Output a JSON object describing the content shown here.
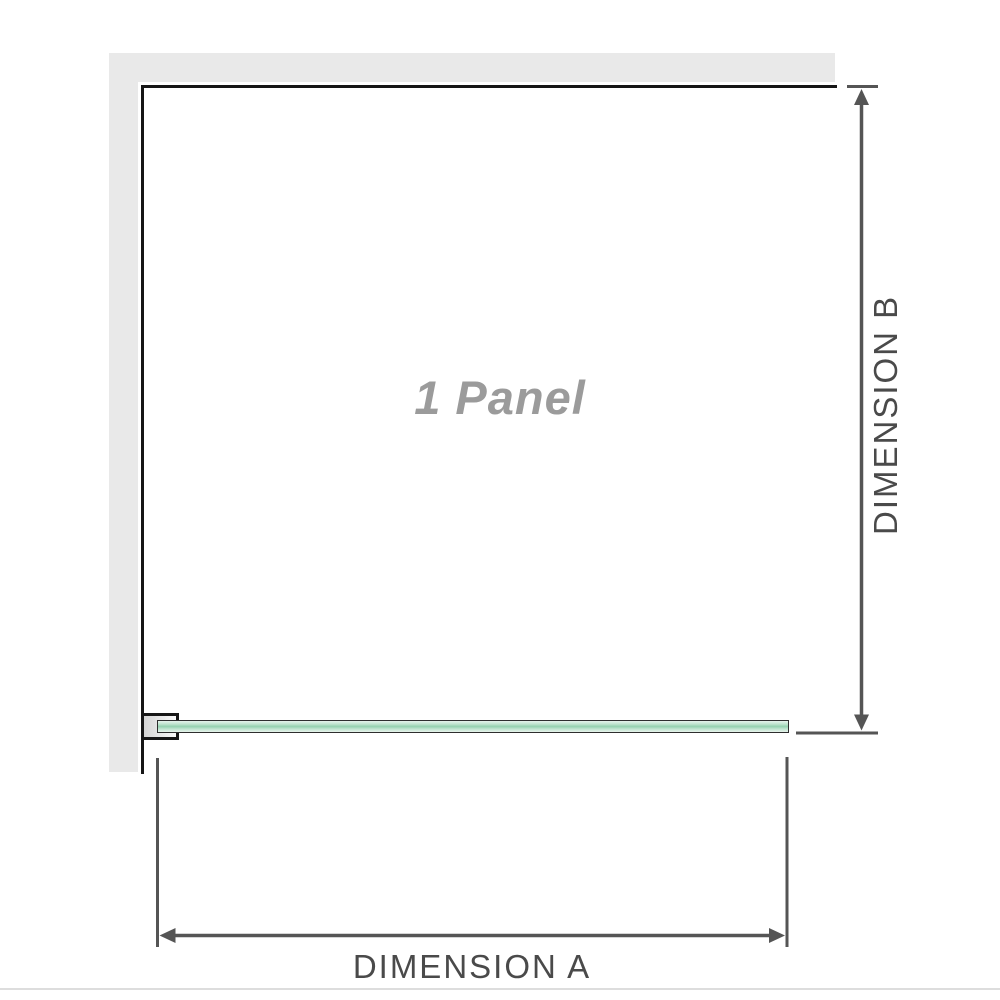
{
  "panel": {
    "label": "1 Panel"
  },
  "dimensions": {
    "a_label": "DIMENSION A",
    "b_label": "DIMENSION B"
  },
  "colors": {
    "background": "#ffffff",
    "wall_fill": "#e9e9e9",
    "wall_edge": "#161616",
    "glass_outline": "#2e2e2e",
    "glass_light": "#e7f3ec",
    "glass_mid": "#bfe4cf",
    "glass_core": "#94d1af",
    "bracket_edge": "#161616",
    "bracket_fill_dark": "#d4d4d4",
    "bracket_fill_light": "#fafafa",
    "dim_line": "#555555",
    "dim_text": "#4a4a4a",
    "panel_text": "#9b9b9b",
    "footer_line": "#dddddd"
  }
}
